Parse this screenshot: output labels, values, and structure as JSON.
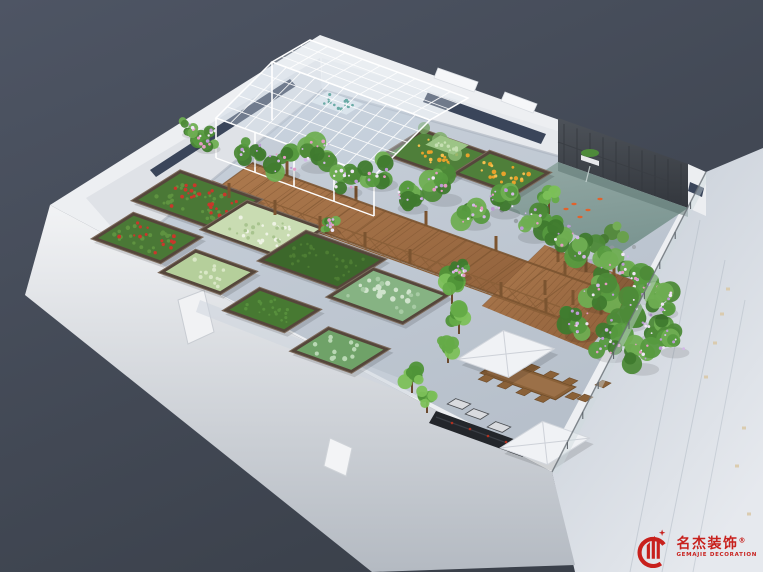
{
  "image": {
    "type": "3d-architectural-rendering",
    "subject": "aerial isometric view of a rooftop vegetable garden terrace",
    "width": 763,
    "height": 572
  },
  "watermark": {
    "brand_cn": "名杰装饰",
    "registered": "®",
    "brand_en": "GEMAJIE DECORATION",
    "color": "#c8211d"
  },
  "palette": {
    "background_top": "#4e5564",
    "background_bottom": "#3a404a",
    "wall_white": "#edeff2",
    "pavement": "#c4ccd6",
    "accent_navy": "#3a455a",
    "deck_wood": "#a8744a",
    "pond_water": "#8aa19d",
    "slate_wall": "#45494f",
    "foliage_green": "#4e8a3a",
    "flower_purple": "#bd9ad6",
    "tomato_red": "#c9372b",
    "marigold_orange": "#e8a22b",
    "canopy_white": "#f0f2f5",
    "grill_black": "#23262b",
    "logo_red": "#c8211d"
  },
  "scene": {
    "labels": {
      "greenhouse": "glass greenhouse",
      "pond": "koi pond with slate feature wall",
      "dining": "outdoor dining set with canopies",
      "walkway": "timber pergola walkway",
      "beds": "raised planting beds"
    },
    "garden_beds": [
      {
        "cx": 197,
        "cy": 200,
        "a": 40,
        "b": 25,
        "crop": "tomatoes",
        "fill": "#4a7836",
        "dots": [
          {
            "color": "#5f9340",
            "n": 26,
            "r": 1.8
          },
          {
            "color": "#c9372b",
            "n": 24,
            "r": 1.6
          }
        ]
      },
      {
        "cx": 147,
        "cy": 238,
        "a": 33,
        "b": 21,
        "crop": "tomatoes",
        "fill": "#4a7836",
        "dots": [
          {
            "color": "#5f9340",
            "n": 20,
            "r": 1.8
          },
          {
            "color": "#c9372b",
            "n": 16,
            "r": 1.5
          }
        ]
      },
      {
        "cx": 263,
        "cy": 229,
        "a": 38,
        "b": 24,
        "crop": "seedlings",
        "fill": "#c9dcb2",
        "dots": [
          {
            "color": "#eef3e4",
            "n": 18,
            "r": 1.8
          },
          {
            "color": "#a8c48e",
            "n": 14,
            "r": 1.6
          }
        ]
      },
      {
        "cx": 208,
        "cy": 272,
        "a": 29,
        "b": 18,
        "crop": "herbs",
        "fill": "#b5cf9b",
        "dots": [
          {
            "color": "#d9e7c6",
            "n": 12,
            "r": 1.7
          }
        ]
      },
      {
        "cx": 322,
        "cy": 260,
        "a": 39,
        "b": 25,
        "crop": "turf",
        "fill": "#3c682b",
        "dots": [
          {
            "color": "#4d7d33",
            "n": 30,
            "r": 1.5
          }
        ]
      },
      {
        "cx": 272,
        "cy": 310,
        "a": 29,
        "b": 18,
        "crop": "turf",
        "fill": "#477932",
        "dots": [
          {
            "color": "#578f3c",
            "n": 20,
            "r": 1.4
          }
        ]
      },
      {
        "cx": 388,
        "cy": 296,
        "a": 37,
        "b": 24,
        "crop": "cabbages",
        "fill": "#86b383",
        "dots": [
          {
            "color": "#cfe3cc",
            "n": 15,
            "r": 2.4
          },
          {
            "color": "#a7cba4",
            "n": 10,
            "r": 2.0
          }
        ]
      },
      {
        "cx": 340,
        "cy": 350,
        "a": 29,
        "b": 19,
        "crop": "cabbages",
        "fill": "#6fa268",
        "dots": [
          {
            "color": "#b9d8b4",
            "n": 12,
            "r": 2.2
          }
        ]
      },
      {
        "cx": 437,
        "cy": 154,
        "a": 33,
        "b": 20,
        "crop": "marigolds",
        "fill": "#4f7f3a",
        "dots": [
          {
            "color": "#e8a22b",
            "n": 13,
            "r": 1.9
          },
          {
            "color": "#f3c04e",
            "n": 8,
            "r": 1.4
          }
        ]
      },
      {
        "cx": 502,
        "cy": 173,
        "a": 29,
        "b": 18,
        "crop": "marigolds",
        "fill": "#4f7f3a",
        "dots": [
          {
            "color": "#e8a22b",
            "n": 11,
            "r": 1.9
          },
          {
            "color": "#f3c04e",
            "n": 7,
            "r": 1.4
          }
        ]
      }
    ],
    "greenhouse_trays": [
      {
        "cx": 337,
        "cy": 103,
        "a": 19,
        "b": 10,
        "fill": "#e6edf2",
        "dots": [
          {
            "color": "#2f8e7e",
            "n": 14,
            "r": 1.3
          }
        ]
      },
      {
        "cx": 447,
        "cy": 145,
        "a": 15,
        "b": 9,
        "fill": "#9cc486",
        "dots": [
          {
            "color": "#c5dfb2",
            "n": 10,
            "r": 1.5
          }
        ]
      }
    ],
    "pergola_posts": [
      [
        229,
        198
      ],
      [
        275,
        215
      ],
      [
        320,
        231
      ],
      [
        365,
        247
      ],
      [
        410,
        264
      ],
      [
        456,
        280
      ],
      [
        501,
        297
      ],
      [
        546,
        313
      ],
      [
        287,
        176
      ],
      [
        356,
        201
      ],
      [
        426,
        226
      ],
      [
        496,
        251
      ],
      [
        565,
        276
      ],
      [
        558,
        262
      ],
      [
        586,
        272
      ],
      [
        614,
        282
      ],
      [
        545,
        295
      ],
      [
        573,
        305
      ],
      [
        601,
        315
      ],
      [
        560,
        330
      ],
      [
        588,
        340
      ]
    ],
    "pergola_vines": [
      [
        205,
        138,
        14
      ],
      [
        188,
        127,
        10
      ],
      [
        250,
        150,
        15
      ],
      [
        282,
        162,
        17
      ],
      [
        315,
        152,
        19
      ],
      [
        345,
        180,
        16
      ],
      [
        378,
        170,
        19
      ],
      [
        410,
        195,
        17
      ],
      [
        442,
        185,
        19
      ],
      [
        472,
        210,
        18
      ],
      [
        502,
        200,
        17
      ],
      [
        532,
        222,
        19
      ],
      [
        562,
        235,
        17
      ],
      [
        588,
        250,
        20
      ],
      [
        615,
        265,
        22
      ],
      [
        643,
        282,
        20
      ],
      [
        598,
        292,
        19
      ],
      [
        626,
        308,
        21
      ],
      [
        654,
        325,
        19
      ],
      [
        610,
        340,
        20
      ],
      [
        578,
        322,
        18
      ],
      [
        640,
        355,
        18
      ],
      [
        660,
        300,
        17
      ],
      [
        672,
        340,
        16
      ],
      [
        330,
        225,
        9
      ],
      [
        460,
        270,
        10
      ]
    ],
    "trees": [
      [
        452,
        282,
        16
      ],
      [
        459,
        314,
        14
      ],
      [
        448,
        344,
        13
      ],
      [
        412,
        374,
        13
      ],
      [
        427,
        397,
        10
      ],
      [
        549,
        196,
        12
      ],
      [
        554,
        226,
        11
      ]
    ],
    "pond": {
      "koi": [
        [
          574,
          204
        ],
        [
          588,
          210
        ],
        [
          580,
          217
        ],
        [
          600,
          199
        ],
        [
          566,
          209
        ]
      ]
    },
    "facade_lights": [
      [
        728,
        289
      ],
      [
        722,
        314
      ],
      [
        715,
        343
      ],
      [
        706,
        377
      ],
      [
        744,
        428
      ],
      [
        737,
        466
      ],
      [
        749,
        514
      ]
    ]
  }
}
